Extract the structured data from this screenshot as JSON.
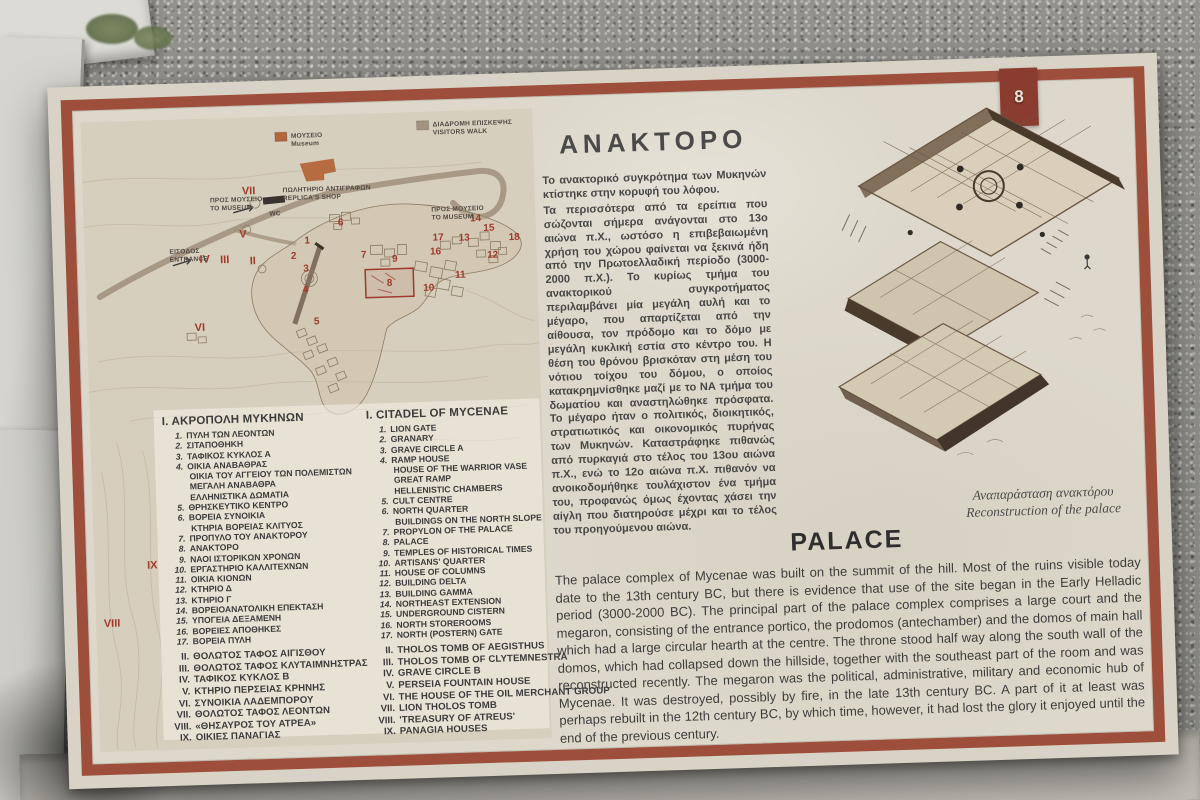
{
  "photo": {
    "badge": "8"
  },
  "sign": {
    "map": {
      "legend": [
        {
          "el": "ΜΟΥΣΕΙΟ",
          "en": "Museum",
          "swatch": "#b4653a",
          "x": 210,
          "y": 22
        },
        {
          "el": "ΔΙΑΔΡΟΜΗ ΕΠΙΣΚΕΨΗΣ",
          "en": "VISITORS WALK",
          "swatch": "#a2927e",
          "x": 352,
          "y": 15
        }
      ],
      "labels": [
        {
          "el": "ΠΩΛΗΤΗΡΙΟ ΑΝΤΙΓΡΑΦΩΝ",
          "en": "REPLICA'S SHOP",
          "x": 200,
          "y": 76
        },
        {
          "el": "WC",
          "en": "",
          "x": 186,
          "y": 99
        },
        {
          "el": "ΠΡΟΣ ΜΟΥΣΕΙΟ",
          "en": "ΤΟ MUSEUM",
          "x": 127,
          "y": 84
        },
        {
          "el": "ΠΡΟΣ ΜΟΥΣΕΙΟ",
          "en": "TO MUSEUM",
          "x": 348,
          "y": 100
        },
        {
          "el": "ΕΙΣΟΔΟΣ",
          "en": "ENTRANCE",
          "x": 85,
          "y": 134
        }
      ],
      "numbers": [
        {
          "t": "1",
          "x": 223,
          "y": 128
        },
        {
          "t": "2",
          "x": 209,
          "y": 143
        },
        {
          "t": "3",
          "x": 221,
          "y": 156
        },
        {
          "t": "4",
          "x": 220,
          "y": 177
        },
        {
          "t": "5",
          "x": 230,
          "y": 209
        },
        {
          "t": "6",
          "x": 257,
          "y": 111
        },
        {
          "t": "7",
          "x": 279,
          "y": 144
        },
        {
          "t": "8",
          "x": 304,
          "y": 173
        },
        {
          "t": "9",
          "x": 310,
          "y": 149
        },
        {
          "t": "10",
          "x": 343,
          "y": 179
        },
        {
          "t": "11",
          "x": 375,
          "y": 167
        },
        {
          "t": "12",
          "x": 408,
          "y": 148
        },
        {
          "t": "13",
          "x": 380,
          "y": 130
        },
        {
          "t": "14",
          "x": 392,
          "y": 111
        },
        {
          "t": "15",
          "x": 405,
          "y": 121
        },
        {
          "t": "16",
          "x": 351,
          "y": 143
        },
        {
          "t": "17",
          "x": 354,
          "y": 129
        },
        {
          "t": "18",
          "x": 430,
          "y": 131
        }
      ],
      "numerals": [
        {
          "t": "II",
          "x": 168,
          "y": 147
        },
        {
          "t": "III",
          "x": 140,
          "y": 145
        },
        {
          "t": "IV",
          "x": 120,
          "y": 144
        },
        {
          "t": "V",
          "x": 159,
          "y": 120
        },
        {
          "t": "VI",
          "x": 113,
          "y": 212
        },
        {
          "t": "VII",
          "x": 166,
          "y": 77
        },
        {
          "t": "VIII",
          "x": 16,
          "y": 505
        },
        {
          "t": "IX",
          "x": 58,
          "y": 448
        }
      ]
    },
    "lists": {
      "greek": {
        "title": "Ι. ΑΚΡΟΠΟΛΗ ΜΥΚΗΝΩΝ",
        "items": [
          {
            "n": "1.",
            "t": "ΠΥΛΗ ΤΩΝ ΛΕΟΝΤΩΝ"
          },
          {
            "n": "2.",
            "t": "ΣΙΤΑΠΟΘΗΚΗ"
          },
          {
            "n": "3.",
            "t": "ΤΑΦΙΚΟΣ ΚΥΚΛΟΣ Α"
          },
          {
            "n": "4.",
            "t": "ΟΙΚΙΑ ΑΝΑΒΑΘΡΑΣ"
          },
          {
            "n": "",
            "t": "ΟΙΚΙΑ ΤΟΥ ΑΓΓΕΙΟΥ ΤΩΝ ΠΟΛΕΜΙΣΤΩΝ"
          },
          {
            "n": "",
            "t": "ΜΕΓΑΛΗ ΑΝΑΒΑΘΡΑ"
          },
          {
            "n": "",
            "t": "ΕΛΛΗΝΙΣΤΙΚΑ ΔΩΜΑΤΙΑ"
          },
          {
            "n": "5.",
            "t": "ΘΡΗΣΚΕΥΤΙΚΟ ΚΕΝΤΡΟ"
          },
          {
            "n": "6.",
            "t": "ΒΟΡΕΙΑ ΣΥΝΟΙΚΙΑ"
          },
          {
            "n": "",
            "t": "ΚΤΗΡΙΑ ΒΟΡΕΙΑΣ ΚΛΙΤΥΟΣ"
          },
          {
            "n": "7.",
            "t": "ΠΡΟΠΥΛΟ ΤΟΥ ΑΝΑΚΤΟΡΟΥ"
          },
          {
            "n": "8.",
            "t": "ΑΝΑΚΤΟΡΟ"
          },
          {
            "n": "9.",
            "t": "ΝΑΟΙ ΙΣΤΟΡΙΚΩΝ ΧΡΟΝΩΝ"
          },
          {
            "n": "10.",
            "t": "ΕΡΓΑΣΤΗΡΙΟ ΚΑΛΛΙΤΕΧΝΩΝ"
          },
          {
            "n": "11.",
            "t": "ΟΙΚΙΑ ΚΙΟΝΩΝ"
          },
          {
            "n": "12.",
            "t": "ΚΤΗΡΙΟ Δ"
          },
          {
            "n": "13.",
            "t": "ΚΤΗΡΙΟ Γ"
          },
          {
            "n": "14.",
            "t": "ΒΟΡΕΙΟΑΝΑΤΟΛΙΚΗ ΕΠΕΚΤΑΣΗ"
          },
          {
            "n": "15.",
            "t": "ΥΠΟΓΕΙΑ ΔΕΞΑΜΕΝΗ"
          },
          {
            "n": "16.",
            "t": "ΒΟΡΕΙΕΣ ΑΠΟΘΗΚΕΣ"
          },
          {
            "n": "17.",
            "t": "ΒΟΡΕΙΑ ΠΥΛΗ"
          }
        ],
        "sections": [
          {
            "n": "II.",
            "t": "ΘΟΛΩΤΟΣ ΤΑΦΟΣ ΑΙΓΙΣΘΟΥ"
          },
          {
            "n": "III.",
            "t": "ΘΟΛΩΤΟΣ ΤΑΦΟΣ ΚΛΥΤΑΙΜΝΗΣΤΡΑΣ"
          },
          {
            "n": "IV.",
            "t": "ΤΑΦΙΚΟΣ ΚΥΚΛΟΣ Β"
          },
          {
            "n": "V.",
            "t": "ΚΤΗΡΙΟ ΠΕΡΣΕΙΑΣ ΚΡΗΝΗΣ"
          },
          {
            "n": "VI.",
            "t": "ΣΥΝΟΙΚΙΑ ΛΑΔΕΜΠΟΡΟΥ"
          },
          {
            "n": "VII.",
            "t": "ΘΟΛΩΤΟΣ ΤΑΦΟΣ ΛΕΟΝΤΩΝ"
          },
          {
            "n": "VIII.",
            "t": "«ΘΗΣΑΥΡΟΣ ΤΟΥ ΑΤΡΕΑ»"
          },
          {
            "n": "IX.",
            "t": "ΟΙΚΙΕΣ ΠΑΝΑΓΙΑΣ"
          }
        ]
      },
      "english": {
        "title": "I. CITADEL OF MYCENAE",
        "items": [
          {
            "n": "1.",
            "t": "LION GATE"
          },
          {
            "n": "2.",
            "t": "GRANARY"
          },
          {
            "n": "3.",
            "t": "GRAVE CIRCLE A"
          },
          {
            "n": "4.",
            "t": "RAMP HOUSE"
          },
          {
            "n": "",
            "t": "HOUSE OF THE WARRIOR VASE"
          },
          {
            "n": "",
            "t": "GREAT RAMP"
          },
          {
            "n": "",
            "t": "HELLENISTIC CHAMBERS"
          },
          {
            "n": "5.",
            "t": "CULT CENTRE"
          },
          {
            "n": "6.",
            "t": "NORTH QUARTER"
          },
          {
            "n": "",
            "t": "BUILDINGS ON THE NORTH SLOPE"
          },
          {
            "n": "7.",
            "t": "PROPYLON OF THE PALACE"
          },
          {
            "n": "8.",
            "t": "PALACE"
          },
          {
            "n": "9.",
            "t": "TEMPLES OF HISTORICAL TIMES"
          },
          {
            "n": "10.",
            "t": "ARTISANS' QUARTER"
          },
          {
            "n": "11.",
            "t": "HOUSE OF COLUMNS"
          },
          {
            "n": "12.",
            "t": "BUILDING DELTA"
          },
          {
            "n": "13.",
            "t": "BUILDING GAMMA"
          },
          {
            "n": "14.",
            "t": "NORTHEAST EXTENSION"
          },
          {
            "n": "15.",
            "t": "UNDERGROUND CISTERN"
          },
          {
            "n": "16.",
            "t": "NORTH STOREROOMS"
          },
          {
            "n": "17.",
            "t": "NORTH (POSTERN) GATE"
          }
        ],
        "sections": [
          {
            "n": "II.",
            "t": "THOLOS TOMB OF AEGISTHUS"
          },
          {
            "n": "III.",
            "t": "THOLOS TOMB OF CLYTEMNESTRA"
          },
          {
            "n": "IV.",
            "t": "GRAVE CIRCLE B"
          },
          {
            "n": "V.",
            "t": "PERSEIA FOUNTAIN HOUSE"
          },
          {
            "n": "VI.",
            "t": "THE HOUSE OF THE OIL MERCHANT GROUP"
          },
          {
            "n": "VII.",
            "t": "LION THOLOS TOMB"
          },
          {
            "n": "VIII.",
            "t": "'TREASURY OF ATREUS'"
          },
          {
            "n": "IX.",
            "t": "PANAGIA HOUSES"
          }
        ]
      }
    },
    "greek_section": {
      "title": "ΑΝΑΚΤΟΡΟ",
      "p1": "Το ανακτορικό συγκρότημα των Μυκηνών κτίστηκε στην κορυφή του λόφου.",
      "p2": "Τα περισσότερα από τα ερείπια που σώζονται σήμερα ανάγονται στο 13ο αιώνα π.Χ., ωστόσο η επιβεβαιωμένη χρήση του χώρου φαίνεται να ξεκινά ήδη από την Πρωτοελλαδική περίοδο (3000-2000 π.Χ.). Το κυρίως τμήμα του ανακτορικού συγκροτήματος περιλαμβάνει μία μεγάλη αυλή και το μέγαρο, που απαρτίζεται από την αίθουσα, τον πρόδομο και το δόμο με μεγάλη κυκλική εστία στο κέντρο του. Η θέση του θρόνου βρισκόταν στη μέση του νότιου τοίχου του δόμου, ο οποίος κατακρημνίσθηκε μαζί με το ΝΑ τμήμα του δωματίου και αναστηλώθηκε πρόσφατα. Το μέγαρο ήταν ο πολιτικός, διοικητικός, στρατιωτικός και οικονομικός πυρήνας των Μυκηνών. Καταστράφηκε πιθανώς από πυρκαγιά στο τέλος του 13ου αιώνα π.Χ., ενώ το 12ο αιώνα π.Χ. πιθανόν να ανοικοδομήθηκε τουλάχιστον ένα τμήμα του, προφανώς όμως έχοντας χάσει την αίγλη που διατηρούσε μέχρι και το τέλος του προηγούμενου αιώνα."
    },
    "reconstruction": {
      "caption_el": "Αναπαράσταση ανακτόρου",
      "caption_en": "Reconstruction of the palace"
    },
    "palace_section": {
      "title": "PALACE",
      "body": "The palace complex of Mycenae was built on the summit of the hill. Most of the ruins visible today date to the 13th century BC, but there is evidence that use of the site began in the Early Helladic period (3000-2000 BC). The principal part of the palace complex comprises a large court and the megaron, consisting of the entrance portico, the prodomos (antechamber) and the domos of main hall which had a large circular hearth at the centre. The throne stood half way along the south wall of the domos, which had collapsed down the hillside, together with the southeast part of the room and was reconstructed recently. The megaron was the political, administrative, military and economic hub of Mycenae. It was destroyed, possibly by fire, in the late 13th century BC. A part of it at least was perhaps rebuilt in the 12th century BC, by which time, however, it had lost the glory it enjoyed until the end of the previous century."
    }
  }
}
